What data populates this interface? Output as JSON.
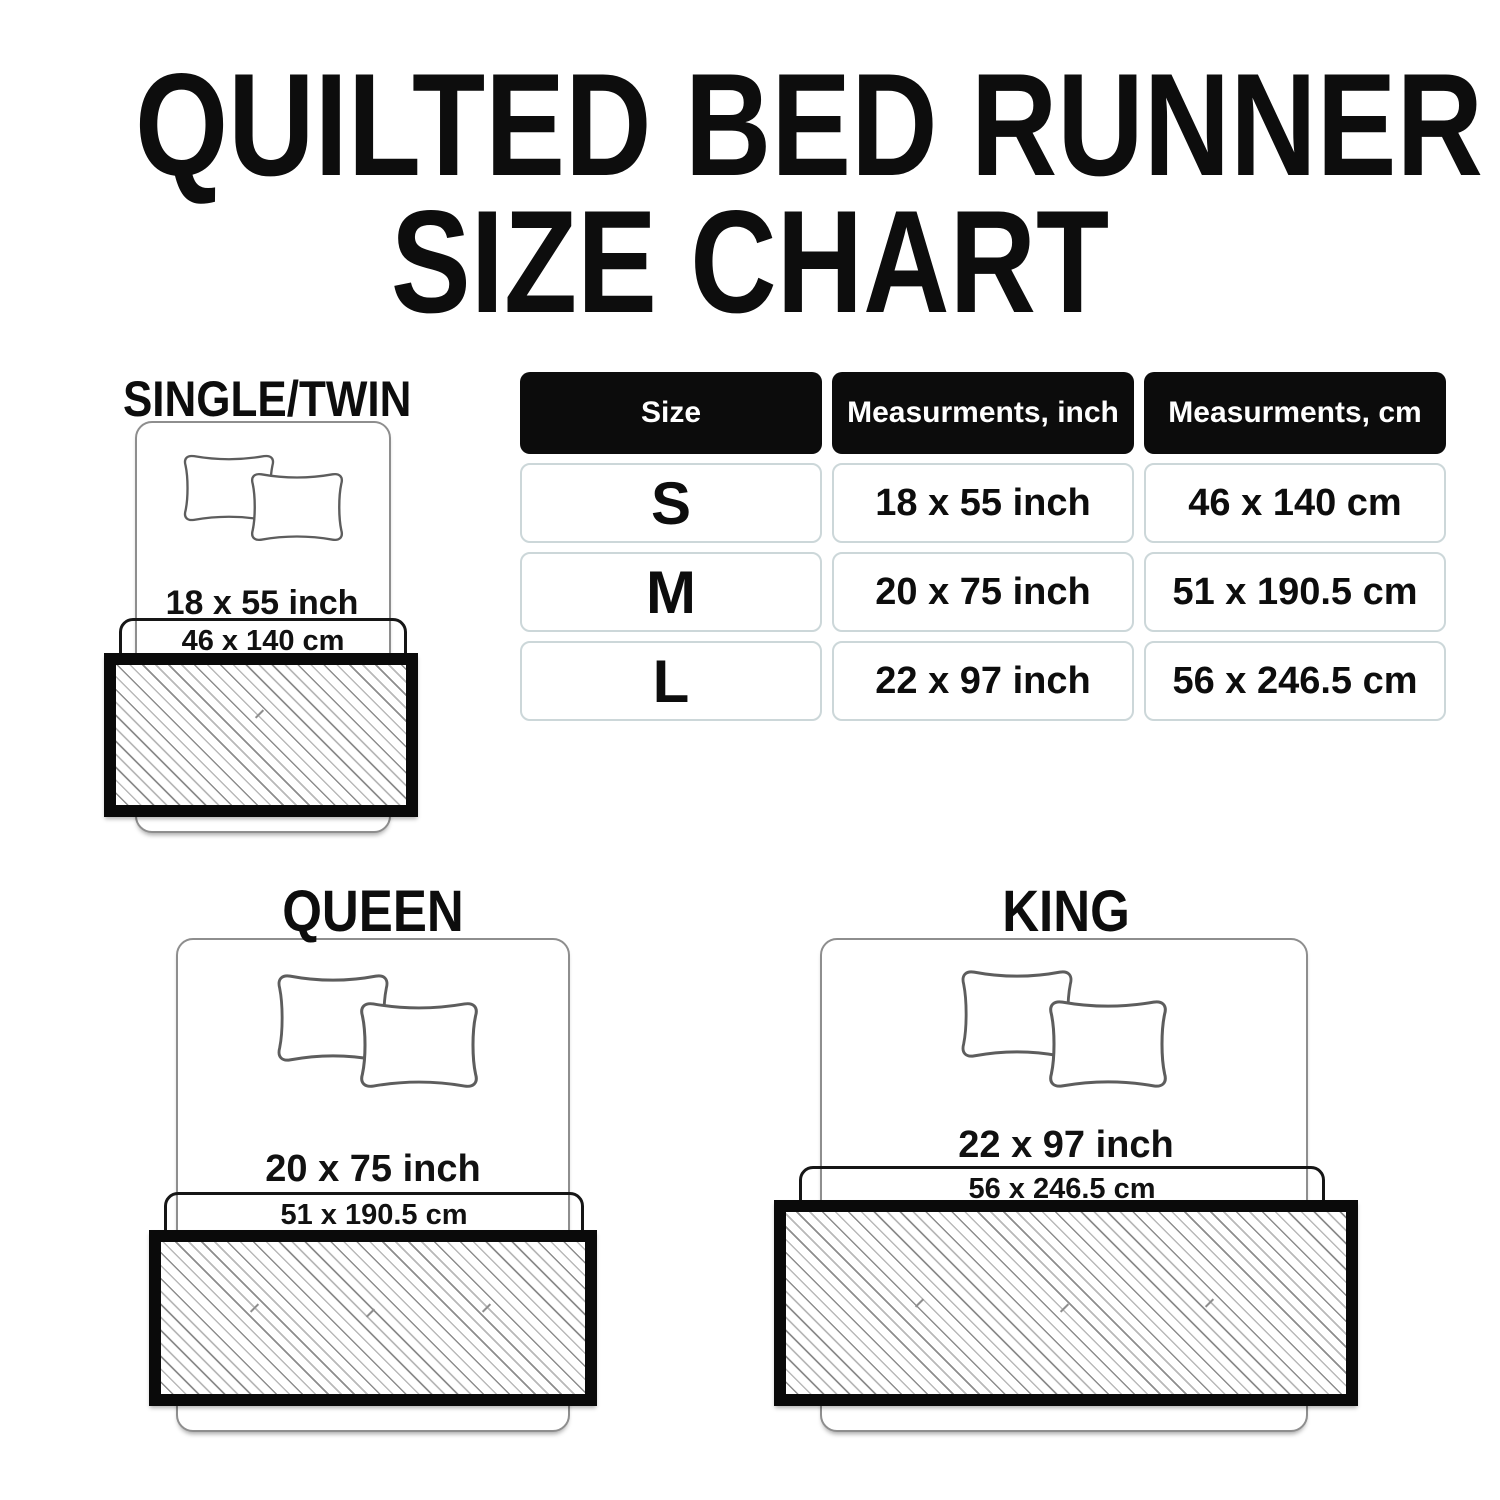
{
  "title": {
    "line1": "QUILTED BED RUNNER",
    "line2": "SIZE CHART"
  },
  "size_table": {
    "headers": [
      "Size",
      "Measurments, inch",
      "Measurments, cm"
    ],
    "rows": [
      {
        "size": "S",
        "inch": "18 x 55 inch",
        "cm": "46 x 140 cm"
      },
      {
        "size": "M",
        "inch": "20 x 75 inch",
        "cm": "51 x 190.5 cm"
      },
      {
        "size": "L",
        "inch": "22 x 97 inch",
        "cm": "56 x 246.5 cm"
      }
    ]
  },
  "diagrams": [
    {
      "label": "SINGLE/TWIN",
      "inch": "18 x 55 inch",
      "cm": "46 x 140 cm"
    },
    {
      "label": "QUEEN",
      "inch": "20 x 75 inch",
      "cm": "51 x 190.5 cm"
    },
    {
      "label": "KING",
      "inch": "22 x 97 inch",
      "cm": "56 x 246.5 cm"
    }
  ],
  "colors": {
    "background": "#ffffff",
    "text": "#111111",
    "table_header_bg": "#0c0c0c",
    "table_header_text": "#ffffff",
    "table_cell_border": "#ccd7d9",
    "bed_outline": "#8e8e8e",
    "pillow_outline": "#5d5d5d",
    "runner_border": "#0a0a0a",
    "hatch_line": "#8d8d8d"
  }
}
